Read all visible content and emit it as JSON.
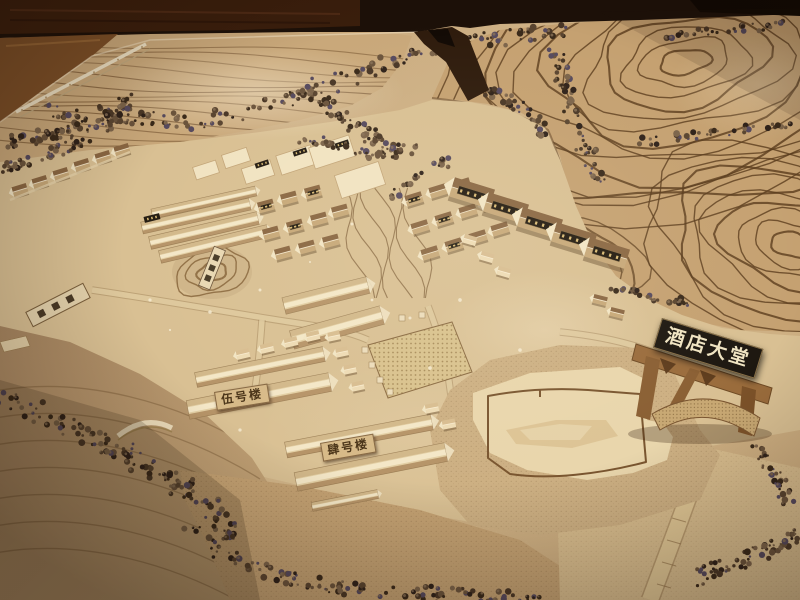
{
  "labels": {
    "hotel_lobby": {
      "text": "酒店大堂"
    },
    "building_no5": {
      "text": "伍号楼"
    },
    "building_no4": {
      "text": "肆号楼"
    }
  },
  "colors": {
    "background_dark": "#1c1008",
    "wood_floor": "#7c4f27",
    "terrain_tan": "#cdb083",
    "terrain_light": "#dcc498",
    "contour_brown": "#5d3f20",
    "tree_brown": "#4a3726",
    "building_wood": "#ecd9b3",
    "sign_dark": "#1d1710",
    "sign_text": "#f0e4c2",
    "plaque_tan": "#d7ba88",
    "plaque_text": "#4a3418"
  }
}
